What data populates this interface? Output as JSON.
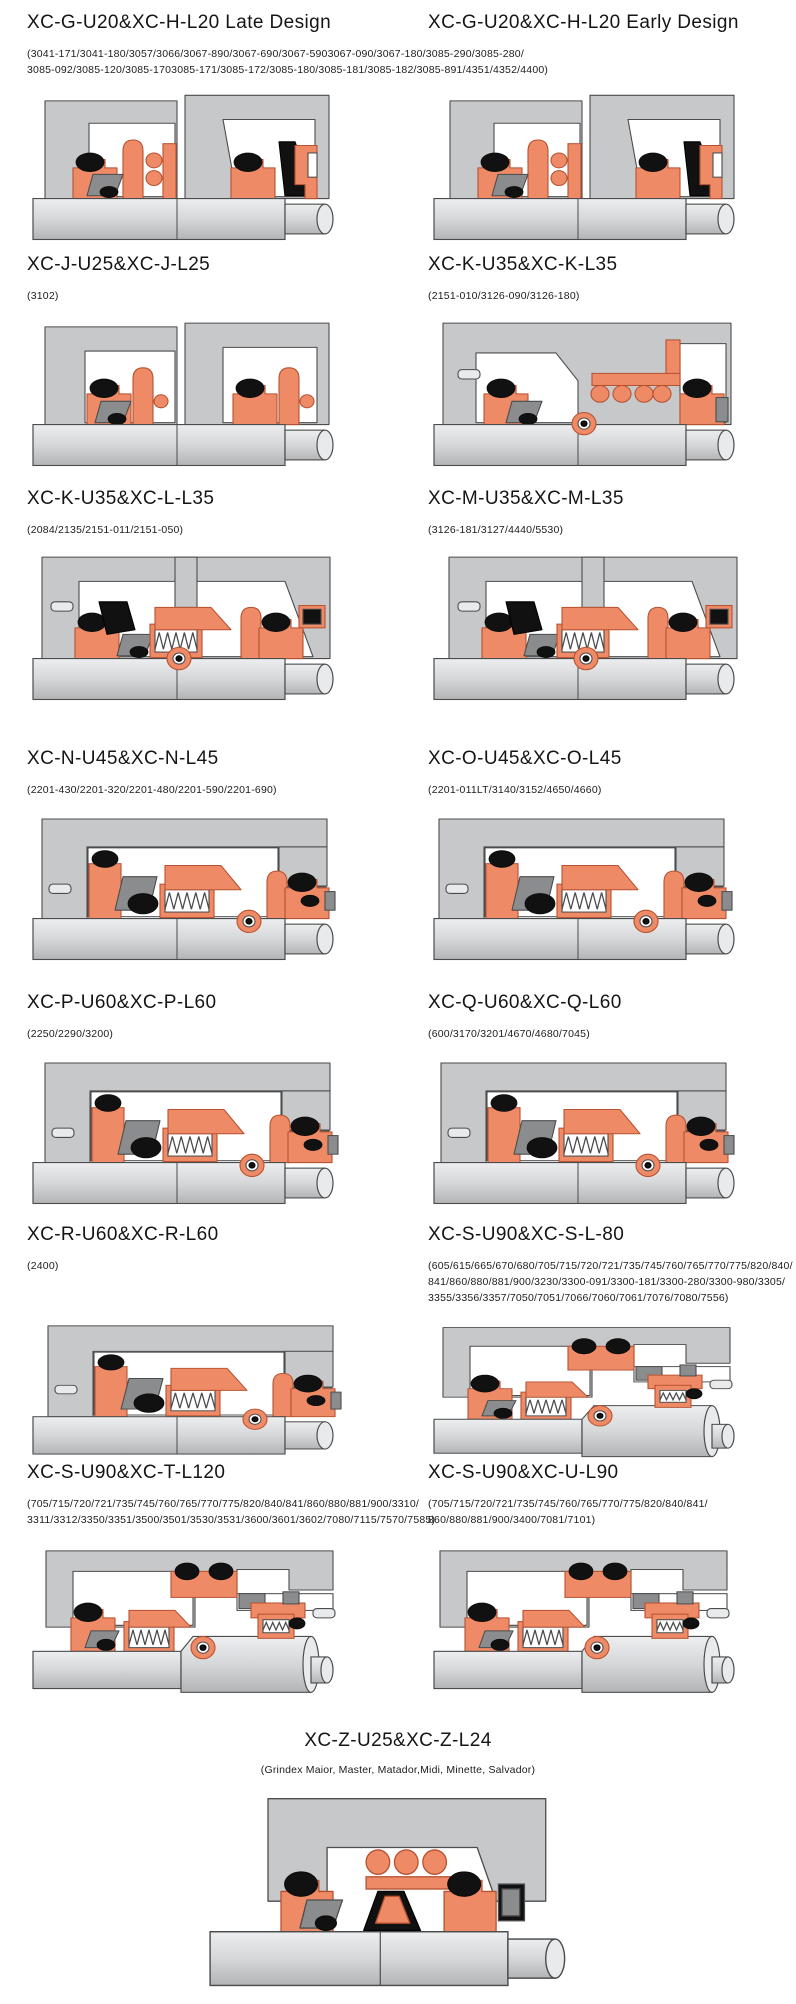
{
  "palette": {
    "housing": "#c7c8ca",
    "outline": "#4b4c4e",
    "seal": "#ee8a66",
    "seal_outline": "#b65231",
    "black": "#111111",
    "gray_part": "#8b8c8e",
    "shaft": "#d6d7d9",
    "shaft_cap": "#e9eaec",
    "white": "#ffffff",
    "page_background": "#ffffff"
  },
  "rows": [
    {
      "left": {
        "title": "XC-G-U20&XC-H-L20 Late Design"
      },
      "right": {
        "title": "XC-G-U20&XC-H-L20 Early Design"
      },
      "shared_parts_lines": [
        "(3041-171/3041-180/3057/3066/3067-890/3067-690/3067-5903067-090/3067-180/3085-290/3085-280/",
        "3085-092/3085-120/3085-1703085-171/3085-172/3085-180/3085-181/3085-182/3085-891/4351/4352/4400)"
      ]
    },
    {
      "left": {
        "title": "XC-J-U25&XC-J-L25",
        "parts_lines": [
          "(3102)"
        ]
      },
      "right": {
        "title": "XC-K-U35&XC-K-L35",
        "parts_lines": [
          "(2151-010/3126-090/3126-180)"
        ]
      }
    },
    {
      "left": {
        "title": "XC-K-U35&XC-L-L35",
        "parts_lines": [
          "(2084/2135/2151-011/2151-050)"
        ]
      },
      "right": {
        "title": "XC-M-U35&XC-M-L35",
        "parts_lines": [
          "(3126-181/3127/4440/5530)"
        ]
      }
    },
    {
      "left": {
        "title": "XC-N-U45&XC-N-L45",
        "parts_lines": [
          "(2201-430/2201-320/2201-480/2201-590/2201-690)"
        ]
      },
      "right": {
        "title": "XC-O-U45&XC-O-L45",
        "parts_lines": [
          "(2201-011LT/3140/3152/4650/4660)"
        ]
      }
    },
    {
      "left": {
        "title": "XC-P-U60&XC-P-L60",
        "parts_lines": [
          "(2250/2290/3200)"
        ]
      },
      "right": {
        "title": "XC-Q-U60&XC-Q-L60",
        "parts_lines": [
          "(600/3170/3201/4670/4680/7045)"
        ]
      }
    },
    {
      "left": {
        "title": "XC-R-U60&XC-R-L60",
        "parts_lines": [
          "(2400)"
        ]
      },
      "right": {
        "title": "XC-S-U90&XC-S-L-80",
        "parts_lines": [
          "(605/615/665/670/680/705/715/720/721/735/745/760/765/770/775/820/840/",
          "841/860/880/881/900/3230/3300-091/3300-181/3300-280/3300-980/3305/",
          "3355/3356/3357/7050/7051/7066/7060/7061/7076/7080/7556)"
        ]
      }
    },
    {
      "left": {
        "title": "XC-S-U90&XC-T-L120",
        "parts_lines": [
          "(705/715/720/721/735/745/760/765/770/775/820/840/841/860/880/881/900/3310/",
          "3311/3312/3350/3351/3500/3501/3530/3531/3600/3601/3602/7080/7115/7570/7585)"
        ]
      },
      "right": {
        "title": "XC-S-U90&XC-U-L90",
        "parts_lines": [
          "(705/715/720/721/735/745/760/765/770/775/820/840/841/",
          "860/880/881/900/3400/7081/7101)"
        ]
      }
    }
  ],
  "footer_panel": {
    "title": "XC-Z-U25&XC-Z-L24",
    "parts_lines": [
      "(Grindex  Maior, Master, Matador,Midi, Minette, Salvador)"
    ]
  }
}
